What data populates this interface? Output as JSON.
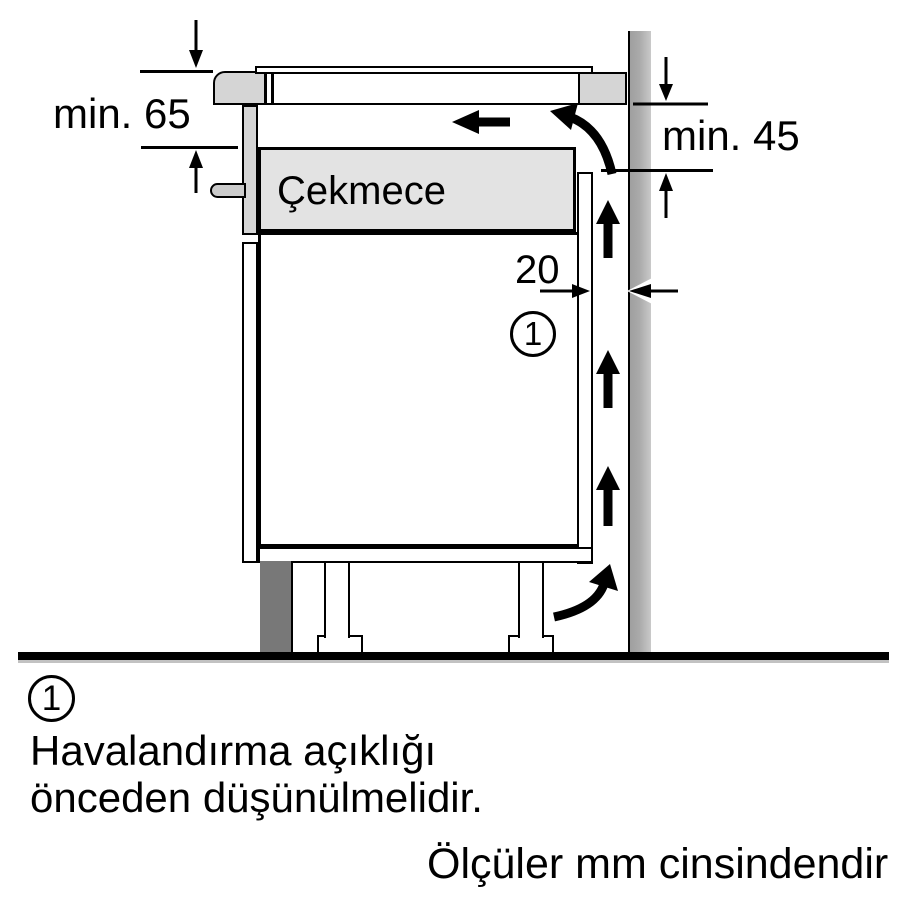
{
  "diagram": {
    "drawer_label": "Çekmece",
    "dims": {
      "top_left": "min. 65",
      "right": "min. 45",
      "gap": "20"
    },
    "callout_number": "1"
  },
  "footer": {
    "callout_number": "1",
    "note_line1": "Havalandırma açıklığı",
    "note_line2": "önceden düşünülmelidir.",
    "units": "Ölçüler mm cinsindendir"
  },
  "colors": {
    "worktop_gray": "#d5d5d5",
    "drawer_fill": "#e3e3e3",
    "wall_gray": "#aaaaaa",
    "plinth_gray": "#787878",
    "line_black": "#000000"
  }
}
